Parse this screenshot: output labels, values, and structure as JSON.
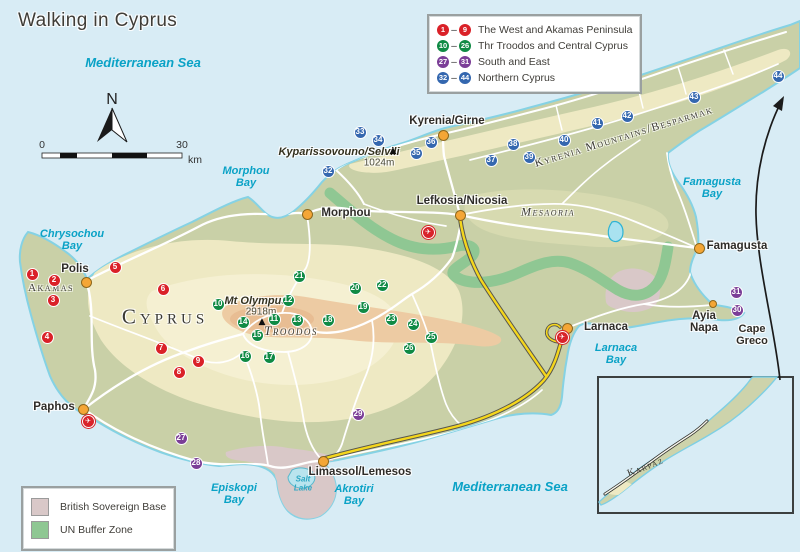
{
  "title": "Walking in Cyprus",
  "compass": {
    "label": "N"
  },
  "scale": {
    "start": "0",
    "end": "30",
    "unit": "km"
  },
  "colors": {
    "sea": "#d8ecf5",
    "land": "#c9d0a7",
    "coast": "#85d2e4",
    "west": "#da2128",
    "troodos": "#0f8a44",
    "south": "#7b3e97",
    "north": "#3467af",
    "town": "#f4a636",
    "motorway": "#f4d61c",
    "buffer": "#8fc793",
    "base": "#d9c8c8",
    "sea_text": "#0aa2c6"
  },
  "legend": {
    "ranges": [
      {
        "key": "west",
        "from": "1",
        "to": "9",
        "label": "The West and Akamas Peninsula",
        "color": "#da2128"
      },
      {
        "key": "troodos",
        "from": "10",
        "to": "26",
        "label": "Thr Troodos and Central Cyprus",
        "color": "#0f8a44"
      },
      {
        "key": "south",
        "from": "27",
        "to": "31",
        "label": "South and East",
        "color": "#7b3e97"
      },
      {
        "key": "north",
        "from": "32",
        "to": "44",
        "label": "Northern Cyprus",
        "color": "#3467af"
      }
    ],
    "zones": [
      {
        "label": "British Sovereign Base",
        "color": "#d9c8c8"
      },
      {
        "label": "UN Buffer Zone",
        "color": "#8fc793"
      }
    ]
  },
  "markers": [
    {
      "n": "1",
      "x": 32,
      "y": 274,
      "g": "west"
    },
    {
      "n": "2",
      "x": 54,
      "y": 280,
      "g": "west"
    },
    {
      "n": "3",
      "x": 53,
      "y": 300,
      "g": "west"
    },
    {
      "n": "4",
      "x": 47,
      "y": 337,
      "g": "west"
    },
    {
      "n": "5",
      "x": 115,
      "y": 267,
      "g": "west"
    },
    {
      "n": "6",
      "x": 163,
      "y": 289,
      "g": "west"
    },
    {
      "n": "7",
      "x": 161,
      "y": 348,
      "g": "west"
    },
    {
      "n": "8",
      "x": 179,
      "y": 372,
      "g": "west"
    },
    {
      "n": "9",
      "x": 198,
      "y": 361,
      "g": "west"
    },
    {
      "n": "10",
      "x": 218,
      "y": 304,
      "g": "troodos"
    },
    {
      "n": "11",
      "x": 274,
      "y": 319,
      "g": "troodos"
    },
    {
      "n": "12",
      "x": 288,
      "y": 300,
      "g": "troodos"
    },
    {
      "n": "13",
      "x": 297,
      "y": 320,
      "g": "troodos"
    },
    {
      "n": "14",
      "x": 243,
      "y": 322,
      "g": "troodos"
    },
    {
      "n": "15",
      "x": 257,
      "y": 335,
      "g": "troodos"
    },
    {
      "n": "16",
      "x": 245,
      "y": 356,
      "g": "troodos"
    },
    {
      "n": "17",
      "x": 269,
      "y": 357,
      "g": "troodos"
    },
    {
      "n": "18",
      "x": 328,
      "y": 320,
      "g": "troodos"
    },
    {
      "n": "19",
      "x": 363,
      "y": 307,
      "g": "troodos"
    },
    {
      "n": "20",
      "x": 355,
      "y": 288,
      "g": "troodos"
    },
    {
      "n": "21",
      "x": 299,
      "y": 276,
      "g": "troodos"
    },
    {
      "n": "22",
      "x": 382,
      "y": 285,
      "g": "troodos"
    },
    {
      "n": "23",
      "x": 391,
      "y": 319,
      "g": "troodos"
    },
    {
      "n": "24",
      "x": 413,
      "y": 324,
      "g": "troodos"
    },
    {
      "n": "25",
      "x": 431,
      "y": 337,
      "g": "troodos"
    },
    {
      "n": "26",
      "x": 409,
      "y": 348,
      "g": "troodos"
    },
    {
      "n": "27",
      "x": 181,
      "y": 438,
      "g": "south"
    },
    {
      "n": "28",
      "x": 196,
      "y": 463,
      "g": "south"
    },
    {
      "n": "29",
      "x": 358,
      "y": 414,
      "g": "south"
    },
    {
      "n": "30",
      "x": 737,
      "y": 310,
      "g": "south"
    },
    {
      "n": "31",
      "x": 736,
      "y": 292,
      "g": "south"
    },
    {
      "n": "32",
      "x": 328,
      "y": 171,
      "g": "north"
    },
    {
      "n": "33",
      "x": 360,
      "y": 132,
      "g": "north"
    },
    {
      "n": "34",
      "x": 378,
      "y": 140,
      "g": "north"
    },
    {
      "n": "35",
      "x": 416,
      "y": 153,
      "g": "north"
    },
    {
      "n": "36",
      "x": 431,
      "y": 142,
      "g": "north"
    },
    {
      "n": "37",
      "x": 491,
      "y": 160,
      "g": "north"
    },
    {
      "n": "38",
      "x": 513,
      "y": 144,
      "g": "north"
    },
    {
      "n": "39",
      "x": 529,
      "y": 157,
      "g": "north"
    },
    {
      "n": "40",
      "x": 564,
      "y": 140,
      "g": "north"
    },
    {
      "n": "41",
      "x": 597,
      "y": 123,
      "g": "north"
    },
    {
      "n": "42",
      "x": 627,
      "y": 116,
      "g": "north"
    },
    {
      "n": "43",
      "x": 694,
      "y": 97,
      "g": "north"
    },
    {
      "n": "44",
      "x": 778,
      "y": 76,
      "g": "north"
    }
  ],
  "towns": [
    {
      "name": "Polis",
      "x": 86,
      "y": 282,
      "lx": 75,
      "ly": 269
    },
    {
      "name": "Paphos",
      "x": 83,
      "y": 409,
      "lx": 54,
      "ly": 407
    },
    {
      "name": "Morphou",
      "x": 307,
      "y": 214,
      "lx": 346,
      "ly": 213
    },
    {
      "name": "Kyrenia/Girne",
      "x": 443,
      "y": 135,
      "lx": 447,
      "ly": 121
    },
    {
      "name": "Lefkosia/Nicosia",
      "x": 460,
      "y": 215,
      "lx": 462,
      "ly": 201
    },
    {
      "name": "Famagusta",
      "x": 699,
      "y": 248,
      "lx": 737,
      "ly": 246
    },
    {
      "name": "Larnaca",
      "x": 567,
      "y": 328,
      "lx": 606,
      "ly": 327
    },
    {
      "name": "Limassol/Lemesos",
      "x": 323,
      "y": 461,
      "lx": 360,
      "ly": 472
    },
    {
      "name": "Ayia\nNapa",
      "x": 713,
      "y": 304,
      "lx": 704,
      "ly": 322,
      "small": true
    }
  ],
  "airports": [
    {
      "x": 88,
      "y": 421
    },
    {
      "x": 428,
      "y": 232
    },
    {
      "x": 562,
      "y": 337
    }
  ],
  "peaks": [
    {
      "name": "Mt Olympus",
      "elev": "2918m",
      "tx": 256,
      "ty": 301,
      "ex": 261,
      "ey": 312,
      "mx": 262,
      "my": 322
    },
    {
      "name": "Kyparissovouno/Selvili",
      "elev": "1024m",
      "tx": 339,
      "ty": 152,
      "ex": 379,
      "ey": 163,
      "mx": 393,
      "my": 151
    }
  ],
  "labels": [
    {
      "text": "Mediterranean Sea",
      "x": 143,
      "y": 63,
      "cls": "sea",
      "size": 13
    },
    {
      "text": "Mediterranean Sea",
      "x": 510,
      "y": 487,
      "cls": "sea",
      "size": 13
    },
    {
      "text": "Chrysochou\nBay",
      "x": 72,
      "y": 241,
      "cls": "sea2",
      "size": 11
    },
    {
      "text": "Morphou\nBay",
      "x": 246,
      "y": 178,
      "cls": "sea2",
      "size": 11
    },
    {
      "text": "Famagusta\nBay",
      "x": 712,
      "y": 189,
      "cls": "sea2",
      "size": 11
    },
    {
      "text": "Larnaca\nBay",
      "x": 616,
      "y": 355,
      "cls": "sea2",
      "size": 11
    },
    {
      "text": "Episkopi\nBay",
      "x": 234,
      "y": 495,
      "cls": "sea2",
      "size": 11
    },
    {
      "text": "Akrotiri\nBay",
      "x": 354,
      "y": 496,
      "cls": "sea2",
      "size": 11
    },
    {
      "text": "Salt\nLake",
      "x": 303,
      "y": 484,
      "cls": "lake",
      "size": 8
    },
    {
      "text": "Akamas",
      "x": 51,
      "y": 289,
      "cls": "region hl",
      "size": 11
    },
    {
      "text": "Cyprus",
      "x": 165,
      "y": 317,
      "cls": "region big hl",
      "size": 21
    },
    {
      "text": "Troodos",
      "x": 291,
      "y": 331,
      "cls": "region it hl",
      "size": 13
    },
    {
      "text": "Mesaoria",
      "x": 548,
      "y": 212,
      "cls": "region it hl",
      "size": 12
    },
    {
      "text": "Kyrenia Mountains/Besparmak",
      "x": 624,
      "y": 137,
      "cls": "region hl",
      "size": 11.5,
      "rot": -17
    },
    {
      "text": "Karpaz",
      "x": 646,
      "y": 468,
      "cls": "region",
      "size": 10,
      "rot": -21
    },
    {
      "text": "Cape\nGreco",
      "x": 752,
      "y": 336,
      "cls": "cape hl",
      "size": 11
    }
  ]
}
